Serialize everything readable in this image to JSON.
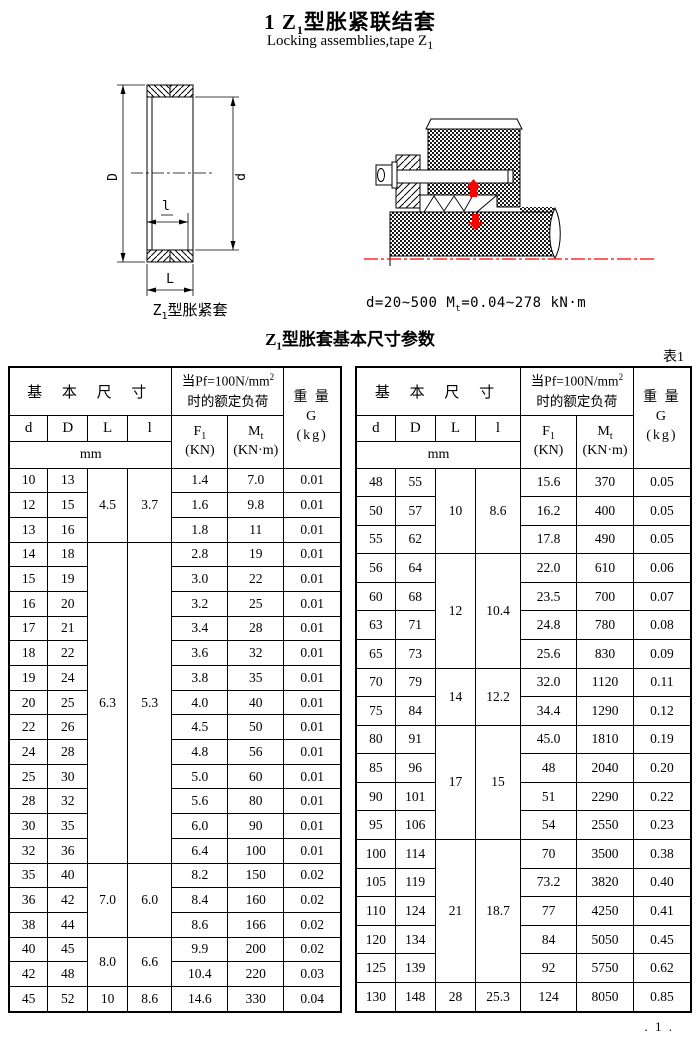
{
  "page": {
    "title": {
      "pre": "1  Z",
      "sub": "1",
      "post": "型胀紧联结套"
    },
    "subtitle": {
      "pre": "Locking assemblies,tape Z",
      "sub": "1"
    },
    "table_title": {
      "pre": "Z",
      "sub": "1",
      "post": "型胀套基本尺寸参数"
    },
    "table_tag": "表1",
    "page_number": ". 1 ."
  },
  "figures": {
    "left_caption": {
      "pre": "Z",
      "sub": "1",
      "post": "型胀紧套"
    },
    "right_caption": {
      "p1": "d=20~500  M",
      "sub": "t",
      "p2": "=0.04~278 kN·m"
    },
    "dim_labels": {
      "D": "D",
      "d": "d",
      "l": "l",
      "L": "L"
    }
  },
  "colors": {
    "accent_red": "#ff0000",
    "line_black": "#000000",
    "paper": "#ffffff"
  },
  "table_header": {
    "basic": "基 本 尺 寸",
    "load1_pre": "当Pf=100N/mm",
    "load1_sup": "2",
    "load2": "时的额定负荷",
    "w1": "重 量",
    "w2": "G",
    "w3": "(kg)",
    "col_d": "d",
    "col_D": "D",
    "col_L": "L",
    "col_l": "l",
    "unit": "mm",
    "f1_pre": "F",
    "f1_sub": "1",
    "f1_unit": "(KN)",
    "mt_pre": "M",
    "mt_sub": "t",
    "mt_unit": "(KN·m)"
  },
  "left_table": {
    "groups": [
      {
        "L": "4.5",
        "l": "3.7",
        "rows": [
          [
            "10",
            "13",
            "1.4",
            "7.0",
            "0.01"
          ],
          [
            "12",
            "15",
            "1.6",
            "9.8",
            "0.01"
          ],
          [
            "13",
            "16",
            "1.8",
            "11",
            "0.01"
          ]
        ]
      },
      {
        "L": "6.3",
        "l": "5.3",
        "rows": [
          [
            "14",
            "18",
            "2.8",
            "19",
            "0.01"
          ],
          [
            "15",
            "19",
            "3.0",
            "22",
            "0.01"
          ],
          [
            "16",
            "20",
            "3.2",
            "25",
            "0.01"
          ],
          [
            "17",
            "21",
            "3.4",
            "28",
            "0.01"
          ],
          [
            "18",
            "22",
            "3.6",
            "32",
            "0.01"
          ],
          [
            "19",
            "24",
            "3.8",
            "35",
            "0.01"
          ],
          [
            "20",
            "25",
            "4.0",
            "40",
            "0.01"
          ],
          [
            "22",
            "26",
            "4.5",
            "50",
            "0.01"
          ],
          [
            "24",
            "28",
            "4.8",
            "56",
            "0.01"
          ],
          [
            "25",
            "30",
            "5.0",
            "60",
            "0.01"
          ],
          [
            "28",
            "32",
            "5.6",
            "80",
            "0.01"
          ],
          [
            "30",
            "35",
            "6.0",
            "90",
            "0.01"
          ],
          [
            "32",
            "36",
            "6.4",
            "100",
            "0.01"
          ]
        ]
      },
      {
        "L": "7.0",
        "l": "6.0",
        "rows": [
          [
            "35",
            "40",
            "8.2",
            "150",
            "0.02"
          ],
          [
            "36",
            "42",
            "8.4",
            "160",
            "0.02"
          ],
          [
            "38",
            "44",
            "8.6",
            "166",
            "0.02"
          ]
        ]
      },
      {
        "L": "8.0",
        "l": "6.6",
        "rows": [
          [
            "40",
            "45",
            "9.9",
            "200",
            "0.02"
          ],
          [
            "42",
            "48",
            "10.4",
            "220",
            "0.03"
          ]
        ]
      },
      {
        "L": "10",
        "l": "8.6",
        "rows": [
          [
            "45",
            "52",
            "14.6",
            "330",
            "0.04"
          ]
        ]
      }
    ]
  },
  "right_table": {
    "groups": [
      {
        "L": "10",
        "l": "8.6",
        "rows": [
          [
            "48",
            "55",
            "15.6",
            "370",
            "0.05"
          ],
          [
            "50",
            "57",
            "16.2",
            "400",
            "0.05"
          ],
          [
            "55",
            "62",
            "17.8",
            "490",
            "0.05"
          ]
        ]
      },
      {
        "L": "12",
        "l": "10.4",
        "rows": [
          [
            "56",
            "64",
            "22.0",
            "610",
            "0.06"
          ],
          [
            "60",
            "68",
            "23.5",
            "700",
            "0.07"
          ],
          [
            "63",
            "71",
            "24.8",
            "780",
            "0.08"
          ],
          [
            "65",
            "73",
            "25.6",
            "830",
            "0.09"
          ]
        ]
      },
      {
        "L": "14",
        "l": "12.2",
        "rows": [
          [
            "70",
            "79",
            "32.0",
            "1120",
            "0.11"
          ],
          [
            "75",
            "84",
            "34.4",
            "1290",
            "0.12"
          ]
        ]
      },
      {
        "L": "17",
        "l": "15",
        "rows": [
          [
            "80",
            "91",
            "45.0",
            "1810",
            "0.19"
          ],
          [
            "85",
            "96",
            "48",
            "2040",
            "0.20"
          ],
          [
            "90",
            "101",
            "51",
            "2290",
            "0.22"
          ],
          [
            "95",
            "106",
            "54",
            "2550",
            "0.23"
          ]
        ]
      },
      {
        "L": "21",
        "l": "18.7",
        "rows": [
          [
            "100",
            "114",
            "70",
            "3500",
            "0.38"
          ],
          [
            "105",
            "119",
            "73.2",
            "3820",
            "0.40"
          ],
          [
            "110",
            "124",
            "77",
            "4250",
            "0.41"
          ],
          [
            "120",
            "134",
            "84",
            "5050",
            "0.45"
          ],
          [
            "125",
            "139",
            "92",
            "5750",
            "0.62"
          ]
        ]
      },
      {
        "L": "28",
        "l": "25.3",
        "rows": [
          [
            "130",
            "148",
            "124",
            "8050",
            "0.85"
          ]
        ]
      }
    ]
  }
}
